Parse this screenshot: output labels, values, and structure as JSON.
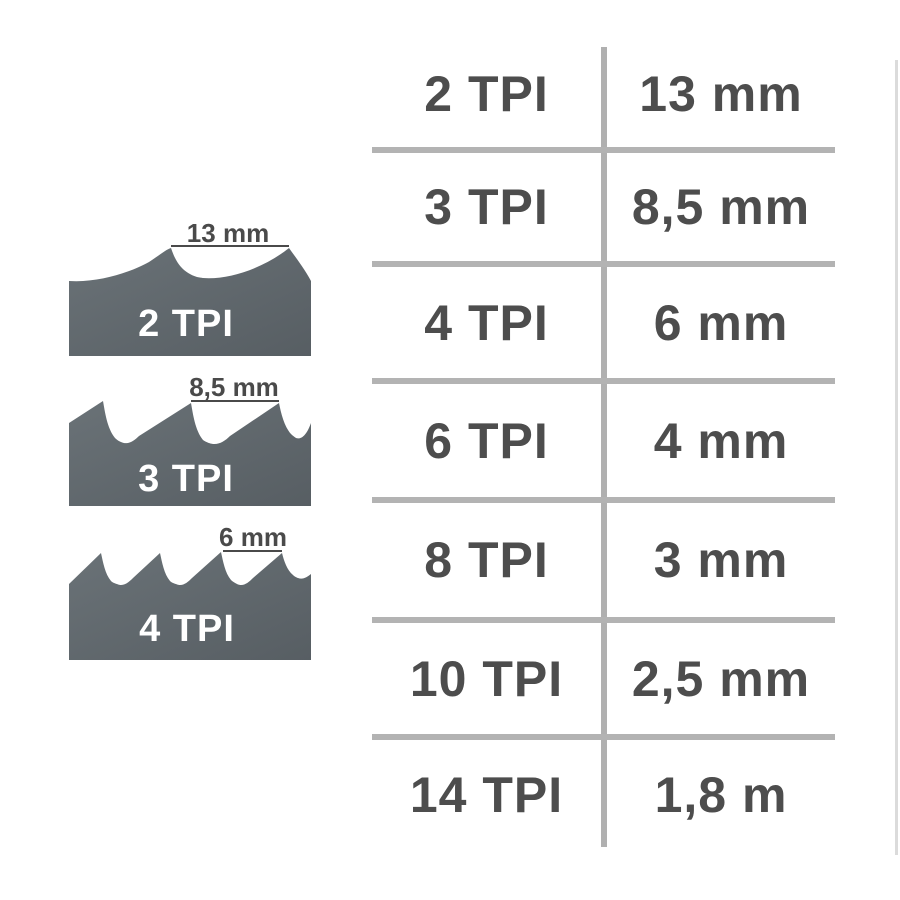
{
  "table": {
    "rows": [
      {
        "tpi": "2 TPI",
        "width": "13 mm"
      },
      {
        "tpi": "3 TPI",
        "width": "8,5 mm"
      },
      {
        "tpi": "4 TPI",
        "width": "6 mm"
      },
      {
        "tpi": "6 TPI",
        "width": "4 mm"
      },
      {
        "tpi": "8 TPI",
        "width": "3 mm"
      },
      {
        "tpi": "10 TPI",
        "width": "2,5 mm"
      },
      {
        "tpi": "14 TPI",
        "width": "1,8 m"
      }
    ]
  },
  "blades": [
    {
      "tpi_label": "2 TPI",
      "measure_label": "13 mm"
    },
    {
      "tpi_label": "3 TPI",
      "measure_label": "8,5 mm"
    },
    {
      "tpi_label": "4 TPI",
      "measure_label": "6 mm"
    }
  ],
  "colors": {
    "blade_fill_light": "#6a7277",
    "blade_fill_dark": "#575e63",
    "text_dark": "#4d4d4d",
    "measure_text": "#4a4a4a",
    "table_line": "#b3b3b3",
    "tpi_label_text": "#ffffff",
    "background": "#ffffff"
  }
}
